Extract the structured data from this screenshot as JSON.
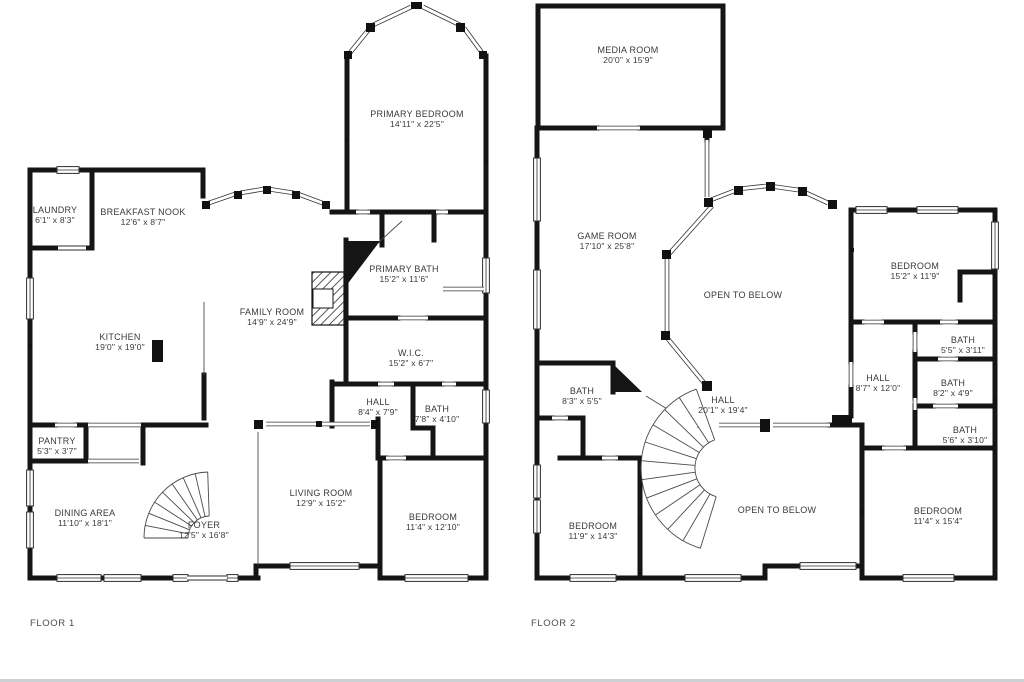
{
  "page": {
    "background": "#ffffff",
    "wall_color": "#151515",
    "thin_color": "#3d3d3d",
    "text_color": "#3a3a3a",
    "footer_line_color": "#ccd1d4"
  },
  "floor1": {
    "label": "FLOOR 1",
    "rooms": {
      "laundry": {
        "name": "LAUNDRY",
        "dims": "6'1\" x 8'3\""
      },
      "breakfast_nook": {
        "name": "BREAKFAST NOOK",
        "dims": "12'6\" x 8'7\""
      },
      "primary_bedroom": {
        "name": "PRIMARY BEDROOM",
        "dims": "14'11\" x 22'5\""
      },
      "primary_bath": {
        "name": "PRIMARY BATH",
        "dims": "15'2\" x 11'6\""
      },
      "family_room": {
        "name": "FAMILY ROOM",
        "dims": "14'9\" x 24'9\""
      },
      "kitchen": {
        "name": "KITCHEN",
        "dims": "19'0\" x 19'0\""
      },
      "wic": {
        "name": "W.I.C.",
        "dims": "15'2\" x 6'7\""
      },
      "hall": {
        "name": "HALL",
        "dims": "8'4\" x 7'9\""
      },
      "bath": {
        "name": "BATH",
        "dims": "7'8\" x 4'10\""
      },
      "pantry": {
        "name": "PANTRY",
        "dims": "5'3\" x 3'7\""
      },
      "dining_area": {
        "name": "DINING AREA",
        "dims": "11'10\" x 18'1\""
      },
      "foyer": {
        "name": "FOYER",
        "dims": "12'5\" x 16'8\""
      },
      "living_room": {
        "name": "LIVING ROOM",
        "dims": "12'9\" x 15'2\""
      },
      "bedroom": {
        "name": "BEDROOM",
        "dims": "11'4\" x 12'10\""
      }
    }
  },
  "floor2": {
    "label": "FLOOR 2",
    "rooms": {
      "media_room": {
        "name": "MEDIA ROOM",
        "dims": "20'0\" x 15'9\""
      },
      "game_room": {
        "name": "GAME ROOM",
        "dims": "17'10\" x 25'8\""
      },
      "open_upper": {
        "name": "OPEN TO BELOW",
        "dims": ""
      },
      "bedroom_tr": {
        "name": "BEDROOM",
        "dims": "15'2\" x 11'9\""
      },
      "bath_a": {
        "name": "BATH",
        "dims": "5'5\" x 3'11\""
      },
      "hall_small": {
        "name": "HALL",
        "dims": "8'7\" x 12'0\""
      },
      "bath_b": {
        "name": "BATH",
        "dims": "8'2\" x 4'9\""
      },
      "bath_c": {
        "name": "BATH",
        "dims": "5'6\" x 3'10\""
      },
      "bath_d": {
        "name": "BATH",
        "dims": "8'3\" x 5'5\""
      },
      "hall_big": {
        "name": "HALL",
        "dims": "20'1\" x 19'4\""
      },
      "open_lower": {
        "name": "OPEN TO BELOW",
        "dims": ""
      },
      "bedroom_bl": {
        "name": "BEDROOM",
        "dims": "11'9\" x 14'3\""
      },
      "bedroom_br": {
        "name": "BEDROOM",
        "dims": "11'4\" x 15'4\""
      }
    }
  }
}
